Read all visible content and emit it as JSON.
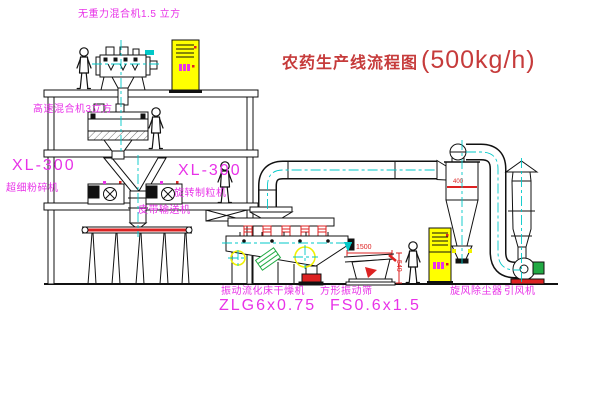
{
  "title": {
    "text_cn": "农药生产线流程图",
    "capacity": "(500kg/h)"
  },
  "equipment_labels": {
    "weightless_mixer": "无重力混合机1.5 立方",
    "high_speed_mixer": "高速混合机3立方",
    "pulverizer_model": "XL-300",
    "pulverizer_name": "超细粉碎机",
    "granulator_model": "XL-300",
    "granulator_name": "旋转制粒机",
    "belt_conveyor": "皮带输送机",
    "dryer_name": "振动流化床干燥机",
    "dryer_model": "ZLG6x0.75",
    "sieve_name": "方形振动筛",
    "sieve_model": "FS0.6x1.5",
    "cyclone_name": "旋风除尘器",
    "fan_name": "引风机"
  },
  "dimensions": {
    "sieve_length": "1500",
    "sieve_height": "540",
    "cyclone_inlet": "400"
  },
  "colors": {
    "label_magenta": "#e832e8",
    "title_red": "#c63b3b",
    "dim_red": "#dd2222",
    "centerline_cyan": "#00c8c8",
    "cabinet_yellow": "#ffff00",
    "motor_green": "#22aa44"
  }
}
